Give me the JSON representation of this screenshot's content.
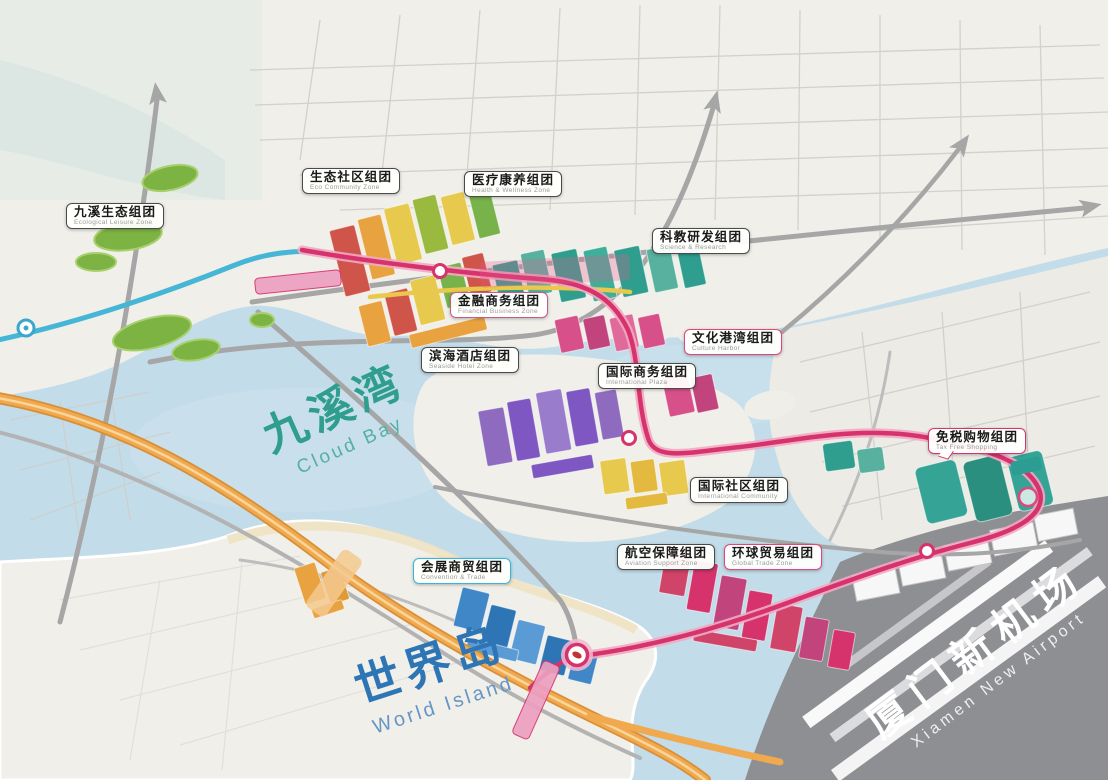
{
  "palette": {
    "water": "#c2dce9",
    "land": "#f0efe9",
    "airport_gray": "#8d8f93",
    "road_gray": "#a6a6a6",
    "metro_pink": "#d6336c",
    "highway_orange": "#f0a94f",
    "line_cyan": "#45b6d6",
    "line_yellow": "#e9c84c",
    "green_space": "#7db343",
    "bay_teal": "#2f9e8f",
    "island_blue": "#2e75b6"
  },
  "place_names": {
    "bay": {
      "zh": "九溪湾",
      "en": "Cloud Bay"
    },
    "island": {
      "zh": "世界岛",
      "en": "World Island"
    },
    "airport": {
      "zh": "厦门新机场",
      "en": "Xiamen New Airport"
    }
  },
  "district_labels": [
    {
      "zh": "九溪生态组团",
      "en": "Ecological Leisure Zone",
      "accent": "#4a4a4a"
    },
    {
      "zh": "生态社区组团",
      "en": "Eco Community Zone",
      "accent": "#4a4a4a"
    },
    {
      "zh": "医疗康养组团",
      "en": "Health & Wellness Zone",
      "accent": "#4a4a4a"
    },
    {
      "zh": "科教研发组团",
      "en": "Science & Research",
      "accent": "#4a4a4a"
    },
    {
      "zh": "金融商务组团",
      "en": "Financial Business Zone",
      "accent": "#c85a8e"
    },
    {
      "zh": "滨海酒店组团",
      "en": "Seaside Hotel Zone",
      "accent": "#4a4a4a"
    },
    {
      "zh": "文化港湾组团",
      "en": "Culture Harbor",
      "accent": "#e0457b"
    },
    {
      "zh": "国际商务组团",
      "en": "International Plaza",
      "accent": "#4a4a4a"
    },
    {
      "zh": "免税购物组团",
      "en": "Tax Free Shopping",
      "accent": "#d6336c"
    },
    {
      "zh": "国际社区组团",
      "en": "International Community",
      "accent": "#4a4a4a"
    },
    {
      "zh": "会展商贸组团",
      "en": "Convention & Trade",
      "accent": "#35b8d8"
    },
    {
      "zh": "航空保障组团",
      "en": "Aviation Support Zone",
      "accent": "#4a4a4a"
    },
    {
      "zh": "环球贸易组团",
      "en": "Global Trade Zone",
      "accent": "#e0457b"
    }
  ]
}
